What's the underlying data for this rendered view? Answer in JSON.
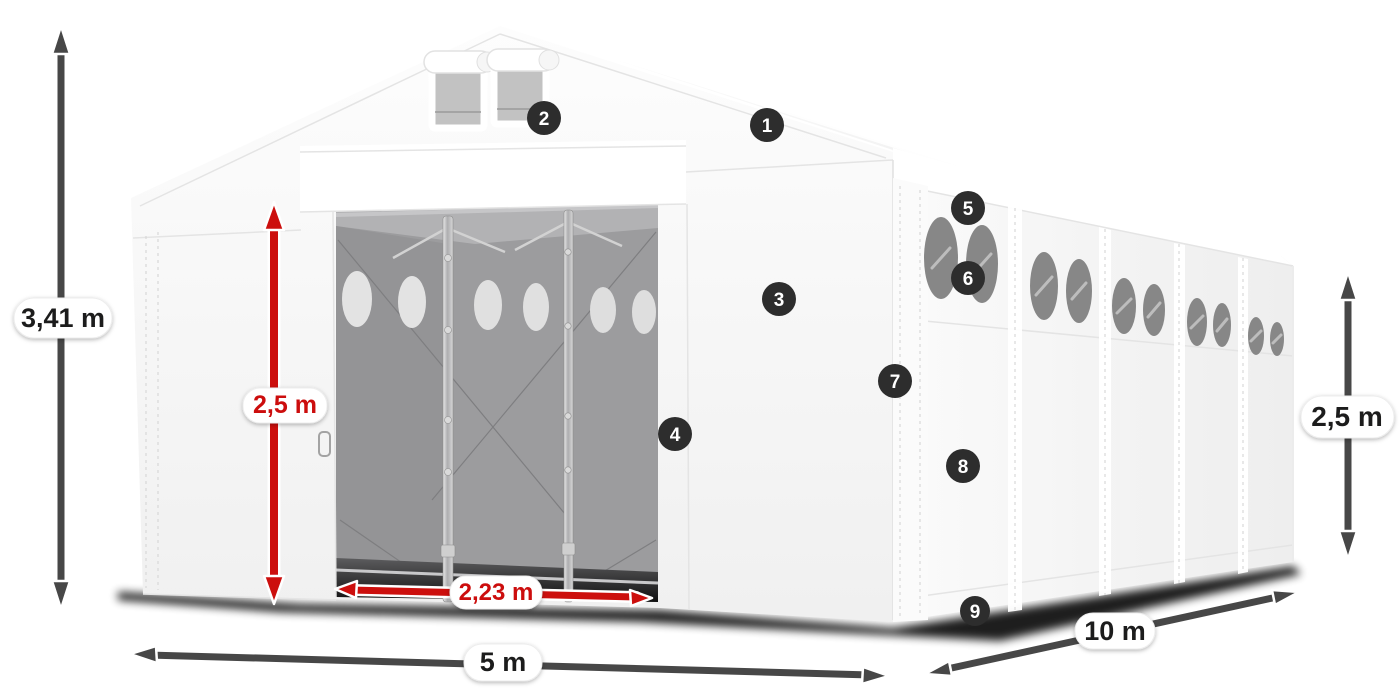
{
  "diagram": {
    "title": "Storage tent dimension diagram",
    "colors": {
      "red_accent": "#cc0f0d",
      "arrow_gray": "#474747",
      "marker_bg": "#2d2d2d",
      "marker_text": "#ffffff",
      "dim_text": "#1d1d1b",
      "pill_bg": "#ffffff"
    },
    "dimensions": {
      "total_height": "3,41 m",
      "door_height": "2,5 m",
      "door_width": "2,23 m",
      "front_width": "5 m",
      "side_length": "10 m",
      "side_wall_height": "2,5 m"
    },
    "markers": [
      {
        "label": "1"
      },
      {
        "label": "2"
      },
      {
        "label": "3"
      },
      {
        "label": "4"
      },
      {
        "label": "5"
      },
      {
        "label": "6"
      },
      {
        "label": "7"
      },
      {
        "label": "8"
      },
      {
        "label": "9"
      }
    ]
  }
}
